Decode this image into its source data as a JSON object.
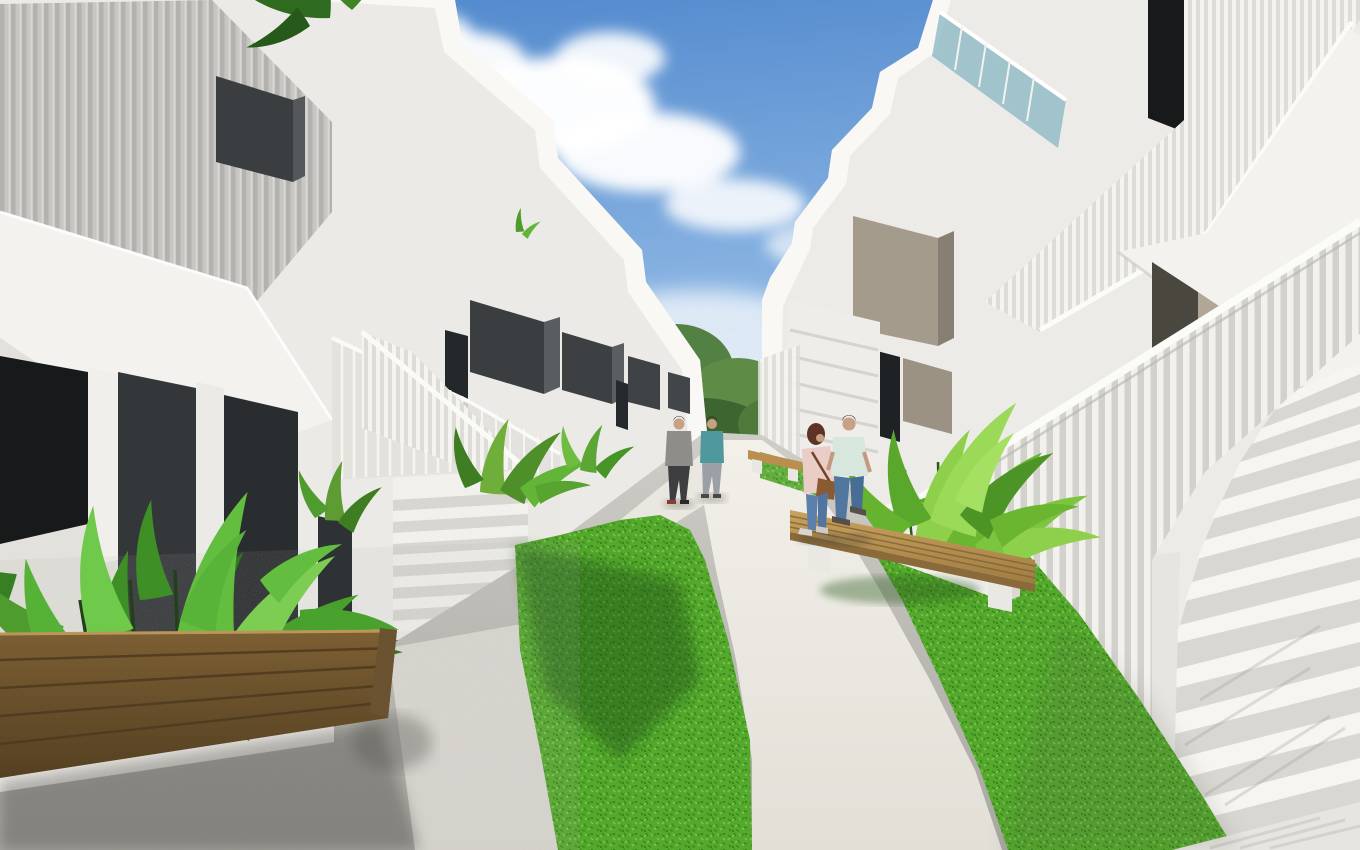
{
  "scene": {
    "kind": "3d-architectural-render",
    "summary": "Modern white two-storey apartment complex with exterior staircases, slatted railings, charcoal privacy panels, winding white walkway, bright lawn strips, wooden benches, tropical planters and four pedestrians under a blue sky with clouds"
  },
  "colors": {
    "sky_top": "#4d86cc",
    "sky_mid": "#8ab4e2",
    "sky_low": "#cfe2f4",
    "sky_horizon": "#eef4fa",
    "cloud": "#ffffff",
    "building_white": "#ebeae6",
    "building_white_right": "#ecebe7",
    "fascia_white": "#f9f8f5",
    "soffit_white": "#f3f2ee",
    "facade_shade": "#e2e1dc",
    "slat_screen": "#c7c6c2",
    "charcoal_panel": "#3b3e41",
    "charcoal_side": "#595d5f",
    "window_dark": "#17191b",
    "taupe_panel": "#a49b8d",
    "taupe_side": "#877f73",
    "glass_teal": "#8fb9c4",
    "door_beige": "#b2a795",
    "door_recess": "#4a473f",
    "riser_grey": "#d8d7d1",
    "tread_white": "#f6f5f1",
    "handrail": "#fbfbf8",
    "grass_base": "#54a82c",
    "grass_dark": "#3c8b1f",
    "grass_light": "#79c94a",
    "grass_shadow": "#1e4d12",
    "path_light": "#f2f0e9",
    "path_mid": "#e2dfd7",
    "pavement_light": "#cfcdc7",
    "pavement_grey": "#a9a7a1",
    "shadow_soft": "#55534e",
    "tree_green": "#538144",
    "tree_dark": "#3c652f",
    "wood_fg": "#7d5f33",
    "wood_fg_dark": "#544022",
    "wood_bench": "#c9a25c",
    "wood_bench_dark": "#a07c42",
    "skin": "#c9a085",
    "woman_hair": "#5f3226",
    "woman_jacket": "#e9cdc6",
    "woman_jeans": "#5c80ad",
    "woman_bag": "#8a5a33",
    "man_shirt": "#d7e7dd",
    "man_jeans": "#51779f",
    "walker_grey_shirt": "#8e8d8a",
    "walker_grey_pants": "#3e3e40",
    "walker_teal_shirt": "#4f999e",
    "walker_teal_pants": "#9aa0a6"
  },
  "objects": {
    "left_building": "white townhouse row with slatted screen and balconies",
    "right_building": "white townhouse row with exterior staircase",
    "main_staircase": "white staircase with vertical slat balustrade",
    "walkway": "curved white concrete path",
    "lawn_left": "lawn strip left of path",
    "lawn_right": "lawn strip along staircase",
    "foreground_bench": "wooden slat bench",
    "right_bench": "wooden bench on white supports",
    "planter_left": "white planter with tropical leaves",
    "planter_right": "white planter with shrubs",
    "pedestrians": "four people walking on the path"
  }
}
